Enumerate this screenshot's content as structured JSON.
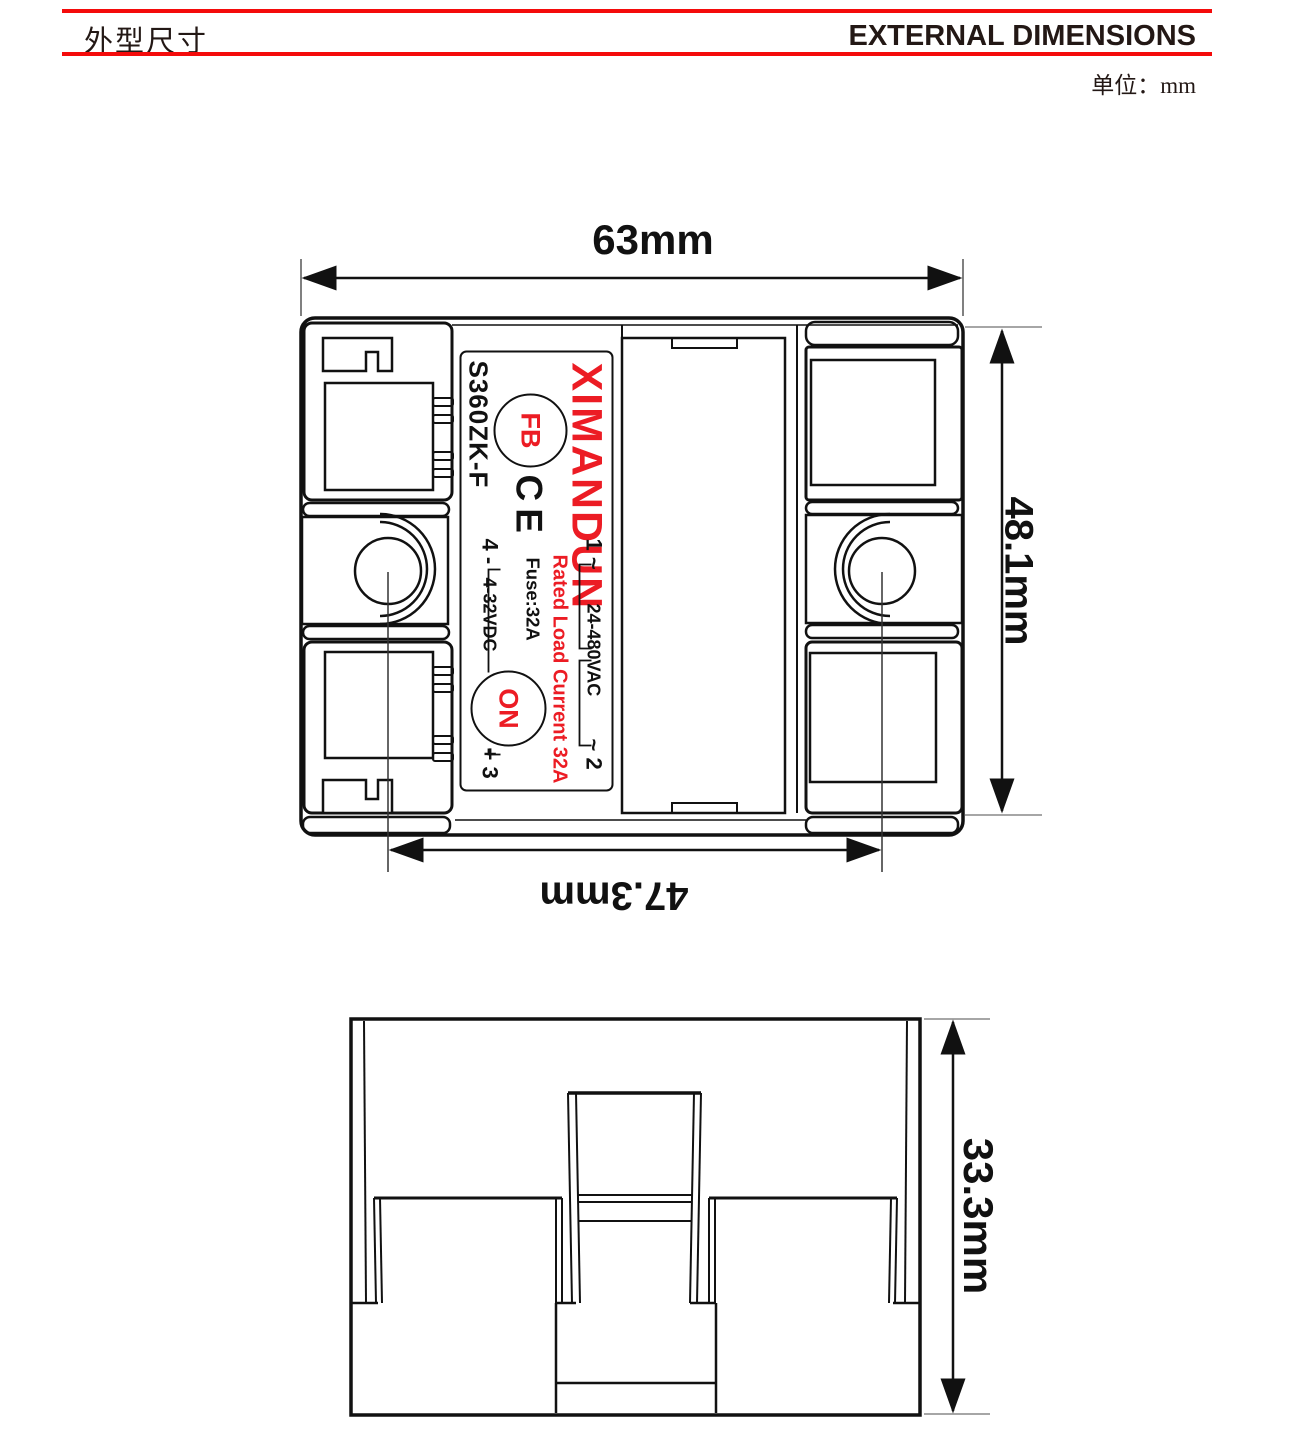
{
  "header": {
    "title_zh": "外型尺寸",
    "title_en": "EXTERNAL DIMENSIONS",
    "unit": "单位：mm"
  },
  "dims": {
    "width": "63mm",
    "height": "48.1mm",
    "hole_spacing": "47.3mm",
    "profile": "33.3mm"
  },
  "label": {
    "brand": "XIMANDUN",
    "model": "S360ZK-F",
    "fb": "FB",
    "ce": "CE",
    "on": "ON",
    "t1": "1 ~",
    "vac": "24-480VAC",
    "t2": "~ 2",
    "rated": "Rated Load Current 32A",
    "fuse": "Fuse:32A",
    "t4": "4 -",
    "vdc": "4-32VDC",
    "t3": "+ 3"
  },
  "colors": {
    "header_rule": "#f40b0b",
    "label_red": "#ec1c24",
    "line_black": "#111111"
  }
}
